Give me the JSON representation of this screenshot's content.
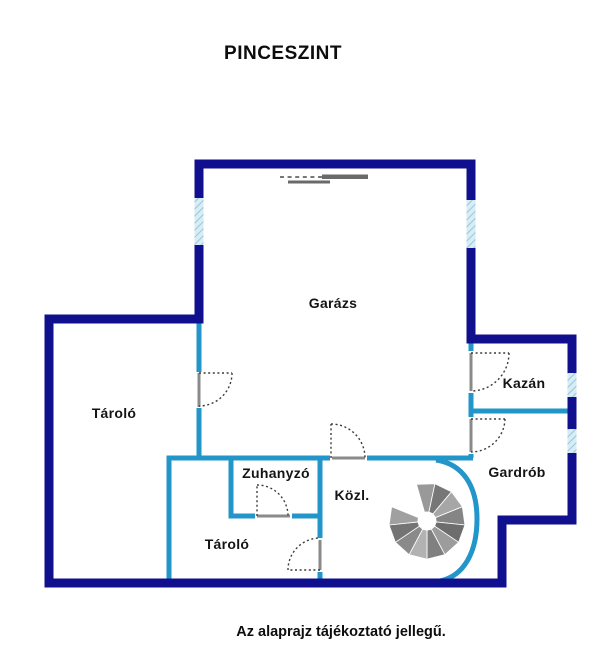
{
  "title": "PINCESZINT",
  "footer_note": "Az alaprajz tájékoztató jellegű.",
  "floor_plan": {
    "level_name": "Pinceszint",
    "rooms": [
      {
        "id": "garazs",
        "label": "Garázs"
      },
      {
        "id": "tarolo-left",
        "label": "Tároló"
      },
      {
        "id": "kazan",
        "label": "Kazán"
      },
      {
        "id": "gardrob",
        "label": "Gardrób"
      },
      {
        "id": "zuhanyzo",
        "label": "Zuhanyzó"
      },
      {
        "id": "kozl",
        "label": "Közl."
      },
      {
        "id": "tarolo-bottom",
        "label": "Tároló"
      }
    ],
    "symbols": [
      "garage-door",
      "spiral-staircase",
      "window",
      "door-swing"
    ],
    "colors": {
      "outer_wall": "#10108e",
      "inner_wall": "#2396c9",
      "window_fill": "#d8ecf5",
      "window_hatch": "#8fc3da",
      "door_leaf": "#8a8a8a",
      "stair_gray": "#8f8f8f",
      "text": "#111111"
    }
  }
}
